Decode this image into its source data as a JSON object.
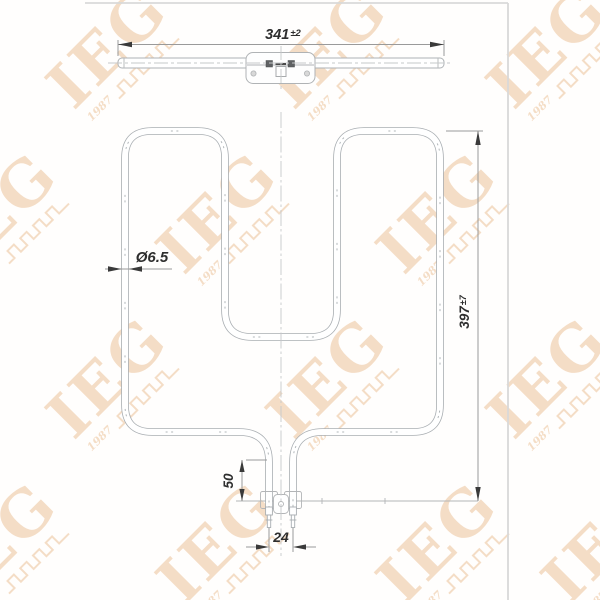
{
  "watermark": {
    "logo_text": "IEG",
    "year_text": "1987",
    "color": "#e09a55",
    "opacity": "0.32"
  },
  "dimensions": {
    "top_width": {
      "value": "341",
      "tolerance": "±2"
    },
    "tube_diameter": {
      "label": "Ø6.5"
    },
    "overall_height": {
      "value": "397",
      "tolerance": "±7"
    },
    "terminal_length": {
      "value": "50"
    },
    "terminal_spacing": {
      "value": "24"
    }
  },
  "colors": {
    "tube_line": "#a9aeb2",
    "dimension_line": "#9a9a9a",
    "dimension_text": "#2e2e2e",
    "centerline": "#c6c8ca",
    "frame_border": "#d9d9d9",
    "background": "#fffefd"
  }
}
